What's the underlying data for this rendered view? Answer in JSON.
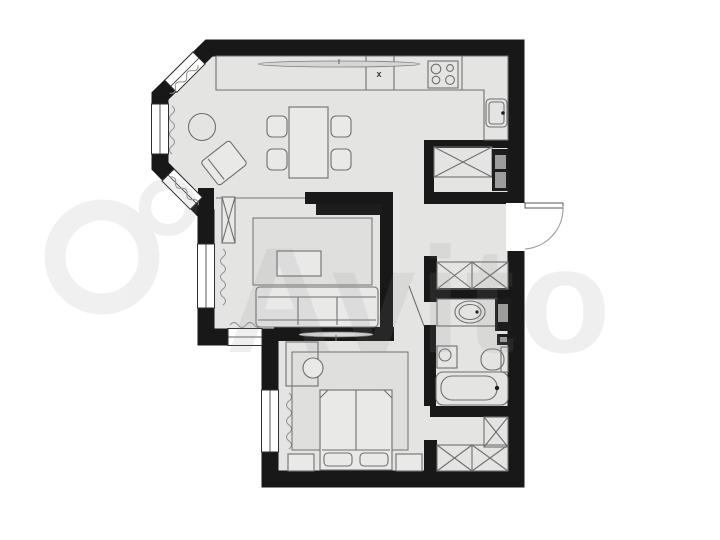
{
  "watermark": {
    "text": "Avito"
  },
  "kitchen": {
    "counter_mark": "x"
  },
  "palette": {
    "background": "#ffffff",
    "wall": "#181818",
    "floor": "#e4e4e3",
    "furniture_outline": "#707070",
    "furniture_fill": "#e9e9e8",
    "rug_fill": "#dfdfde",
    "appliance_dark": "#1d1d1d",
    "appliance_panel": "#9d9d9c",
    "window_line": "#2e2e2e",
    "radiator": "#8f8f8f",
    "watermark_color": "#8e8e8e"
  },
  "fixtures": [
    "bay-windows",
    "radiators",
    "kitchen-counter",
    "cooker-hood",
    "dishwasher",
    "stove",
    "kitchen-sink",
    "refrigerator",
    "built-in-wardrobe",
    "dining-table",
    "dining-chairs",
    "side-table",
    "armchair",
    "tv-panel",
    "shelf-column",
    "sofa",
    "coffee-table",
    "living-rug",
    "entrance-door",
    "hallway-wardrobe",
    "bathroom-door",
    "washbasin",
    "washing-machine",
    "water-heater",
    "toilet",
    "bathtub",
    "dressing-wardrobes",
    "double-bed",
    "pillows",
    "nightstands",
    "desk",
    "stool",
    "bedroom-rug",
    "windows"
  ]
}
